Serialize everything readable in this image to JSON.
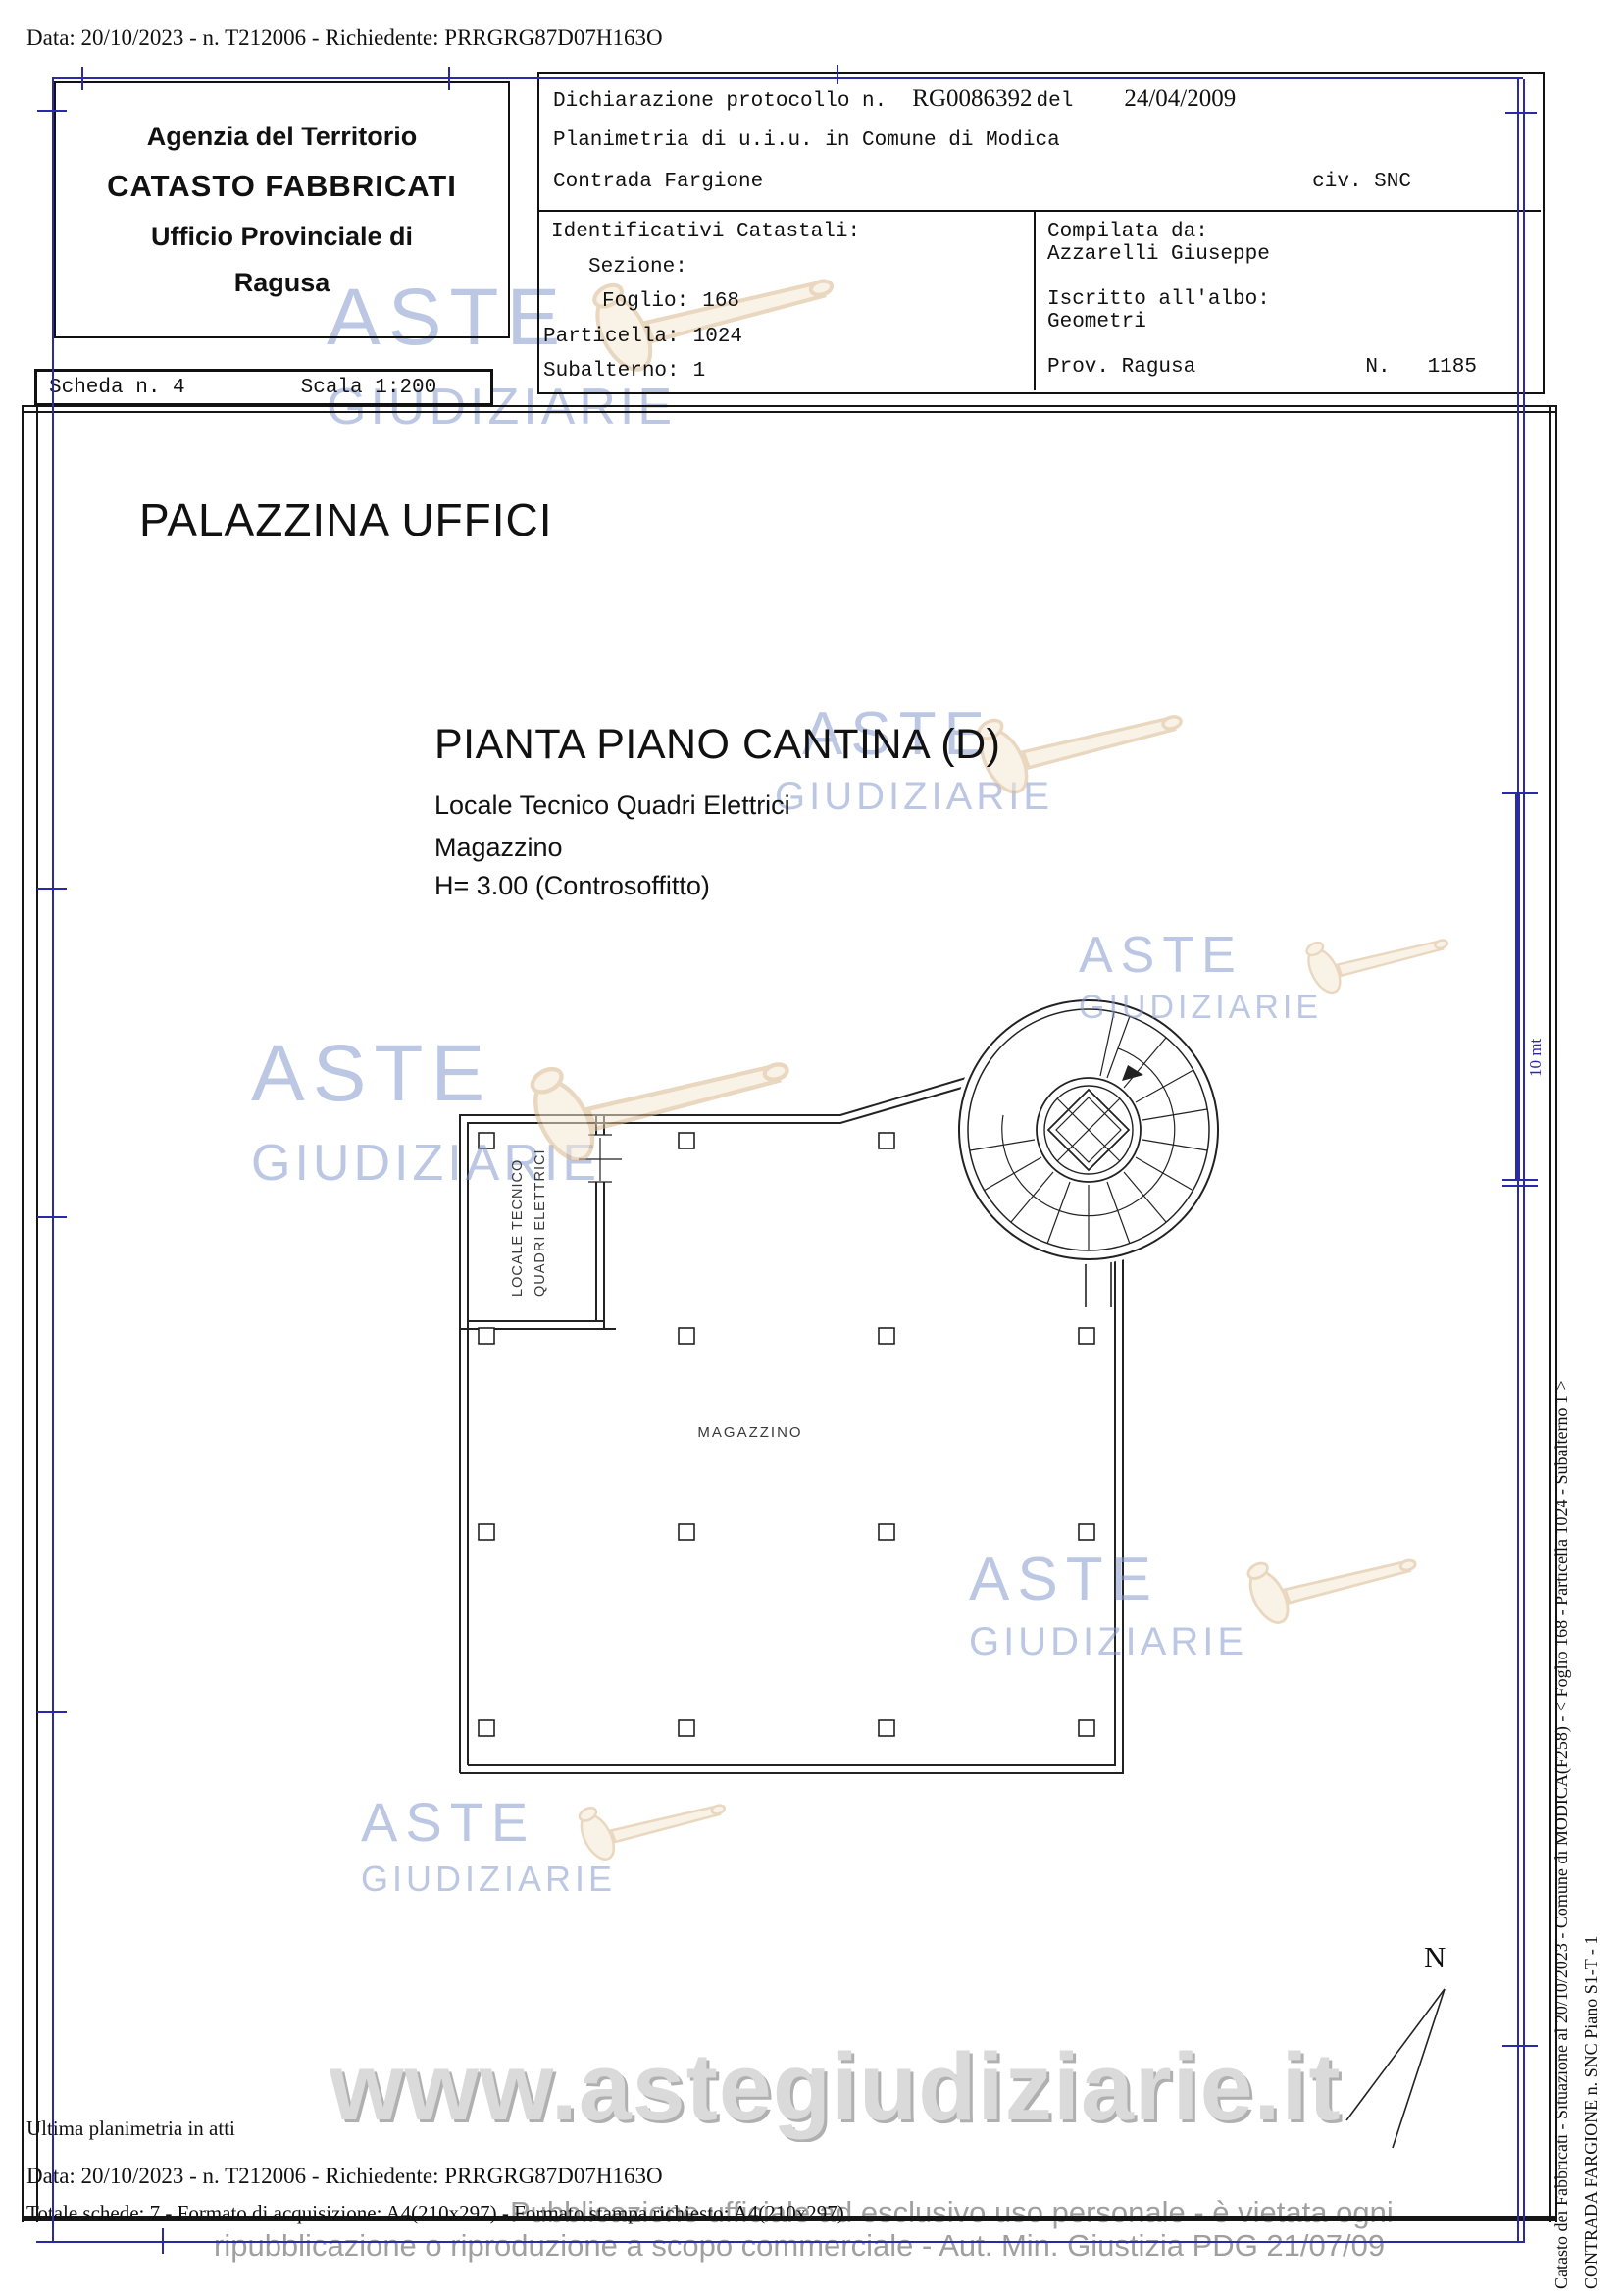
{
  "doc": {
    "top_header": "Data: 20/10/2023 - n. T212006 - Richiedente: PRRGRG87D07H163O",
    "agency": {
      "line1": "Agenzia del Territorio",
      "line2": "CATASTO FABBRICATI",
      "line3": "Ufficio Provinciale di",
      "line4": "Ragusa"
    },
    "declaration": {
      "protocol_prefix": "Dichiarazione protocollo n.",
      "protocol_number": "RG0086392",
      "del_word": "del",
      "protocol_date": "24/04/2009",
      "planimetria_line": "Planimetria di u.i.u. in Comune di Modica",
      "address": "Contrada Fargione",
      "civic": "civ. SNC"
    },
    "identifiers": {
      "title": "Identificativi Catastali:",
      "sezione_label": "Sezione:",
      "foglio_label": "Foglio:",
      "foglio_value": "168",
      "particella_label": "Particella:",
      "particella_value": "1024",
      "subalterno_label": "Subalterno:",
      "subalterno_value": "1"
    },
    "compiler": {
      "compilata_label": "Compilata da:",
      "compilata_name": "Azzarelli Giuseppe",
      "albo_label": "Iscritto all'albo:",
      "albo_value": "Geometri",
      "prov_label": "Prov. Ragusa",
      "number_label": "N.",
      "number_value": "1185"
    },
    "scheda": {
      "label": "Scheda n. 4",
      "scala": "Scala 1:200"
    },
    "building_title": "PALAZZINA UFFICI",
    "plan": {
      "title": "PIANTA PIANO CANTINA (D)",
      "sub1": "Locale Tecnico Quadri Elettrici",
      "sub2": "Magazzino",
      "sub3": "H= 3.00 (Controsoffitto)",
      "room_label_line1": "LOCALE TECNICO",
      "room_label_line2": "QUADRI ELETTRICI",
      "main_room_label": "MAGAZZINO",
      "north_label": "N",
      "scale_bar_label": "10 mt"
    },
    "margin": {
      "line1": "Catasto dei Fabbricati - Situazione al 20/10/2023 - Comune di MODICA(F258) - < Foglio 168 - Particella 1024 - Subalterno 1 >",
      "line2": "CONTRADA FARGIONE n. SNC Piano S1-T - 1"
    },
    "footer": {
      "line1": "Ultima planimetria in atti",
      "line2": "Data: 20/10/2023 - n. T212006 - Richiedente: PRRGRG87D07H163O",
      "line3": "Totale schede: 7 - Formato di acquisizione: A4(210x297) - Formato stampa richiesto: A4(210x297)"
    },
    "watermarks": {
      "aste": "ASTE",
      "giudiziarie": "GIUDIZIARIE",
      "url": "www.astegiudiziarie.it",
      "disclaimer1": "Pubblicazione ufficiale ad esclusivo uso personale - è vietata ogni",
      "disclaimer2": "ripubblicazione o riproduzione a scopo commerciale - Aut. Min. Giustizia PDG 21/07/09"
    },
    "colors": {
      "frame_blue": "#2a2aa8",
      "watermark_blue": "#8599cc",
      "watermark_gray": "#8f8f8f",
      "gavel_beige": "#e7cda4"
    }
  }
}
